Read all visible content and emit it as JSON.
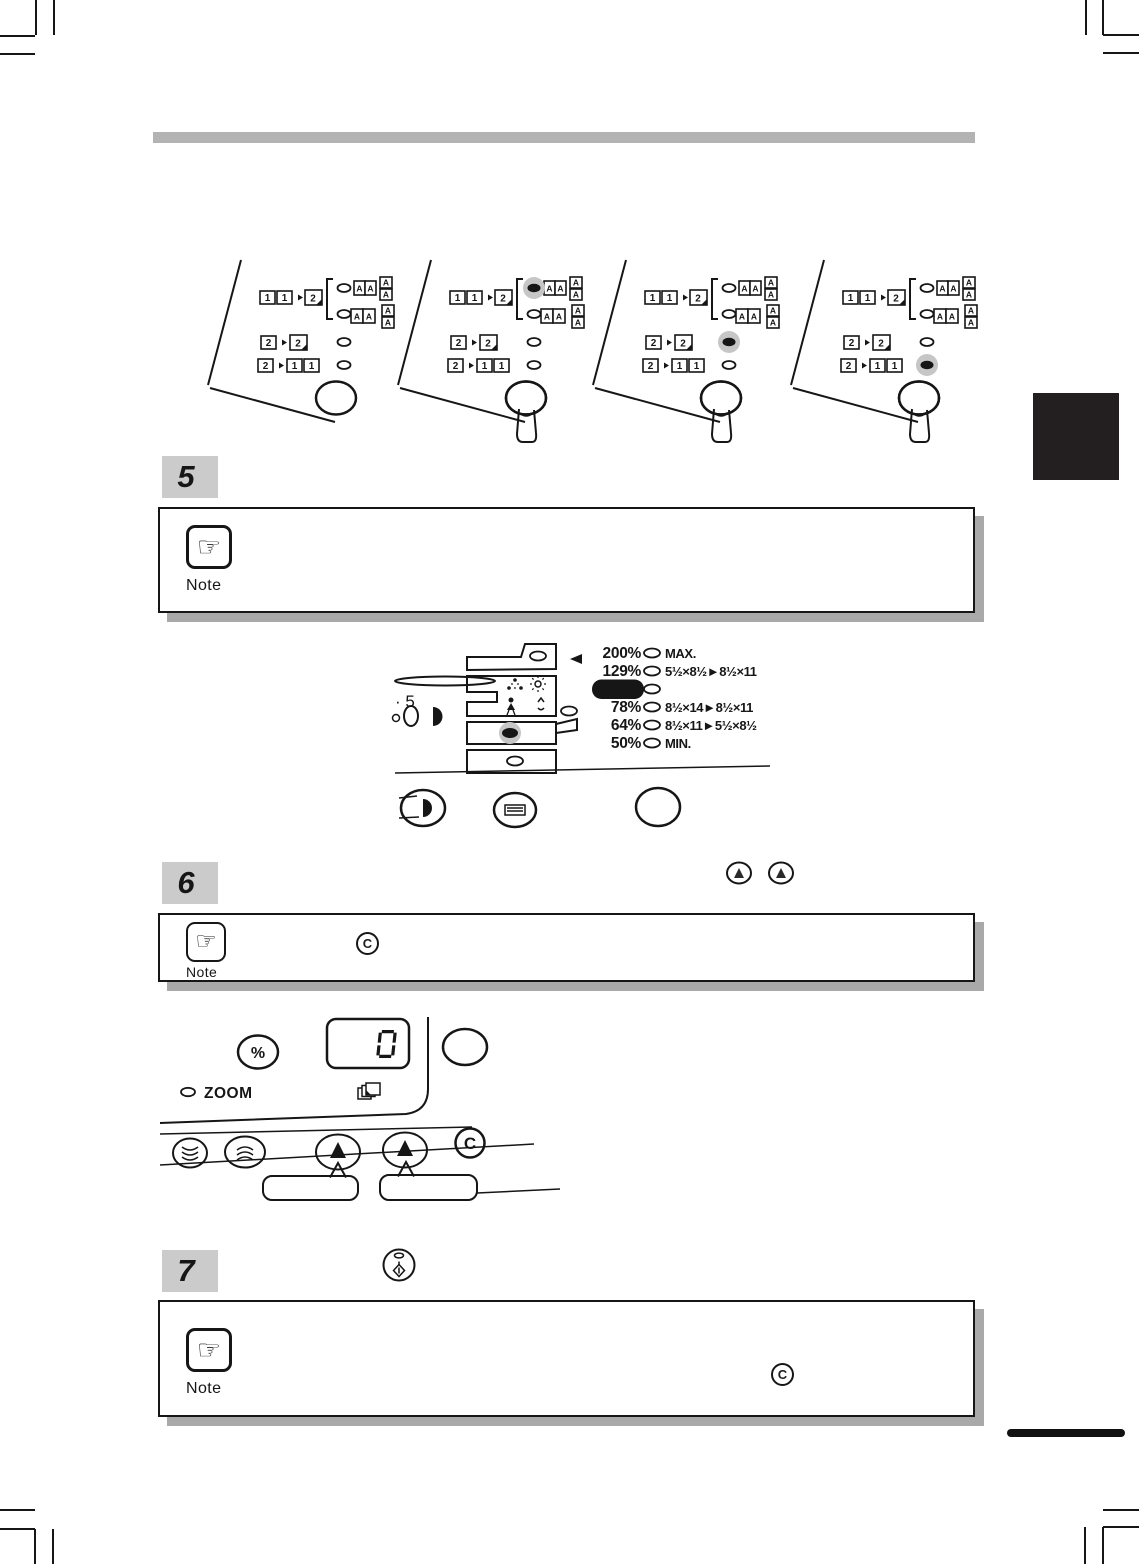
{
  "page": {
    "kind": "copier-operation-manual-page"
  },
  "steps": [
    {
      "number": "5"
    },
    {
      "number": "6"
    },
    {
      "number": "7"
    }
  ],
  "notes": [
    {
      "label": "Note"
    },
    {
      "label": "Note",
      "inline_symbol": "C"
    },
    {
      "label": "Note",
      "inline_symbol": "C"
    }
  ],
  "icons": {
    "note_hand": "☞",
    "digit_one": "1",
    "digit_two": "2",
    "letter_a": "A"
  },
  "duplex_selector": {
    "panels": [
      {
        "lit": "none",
        "pressed": false
      },
      {
        "lit": "one-to-two-book",
        "pressed": true
      },
      {
        "lit": "two-to-two",
        "pressed": true
      },
      {
        "lit": "two-to-one-one",
        "pressed": true
      }
    ]
  },
  "ratio_panel": {
    "exposure_scale_fragment": "· 5",
    "selected_ratio": "100%",
    "rows": [
      {
        "ratio": "200%",
        "label": "MAX."
      },
      {
        "ratio": "129%",
        "label": "5½×8½►8½×11"
      },
      {
        "ratio": "100%",
        "label": ""
      },
      {
        "ratio": "78%",
        "label": "8½×14►8½×11"
      },
      {
        "ratio": "64%",
        "label": "8½×11►5½×8½"
      },
      {
        "ratio": "50%",
        "label": "MIN."
      }
    ]
  },
  "zoom_panel": {
    "percent_button": "%",
    "zoom_indicator": "ZOOM",
    "display_value": "0",
    "clear_button": "C"
  },
  "colors": {
    "button_gray": "#c2c2c2",
    "halo_gray": "#c6c6c6",
    "bar_gray": "#b3b3b3",
    "shadow_gray": "#a9a9a9",
    "tab_black": "#231f20"
  }
}
